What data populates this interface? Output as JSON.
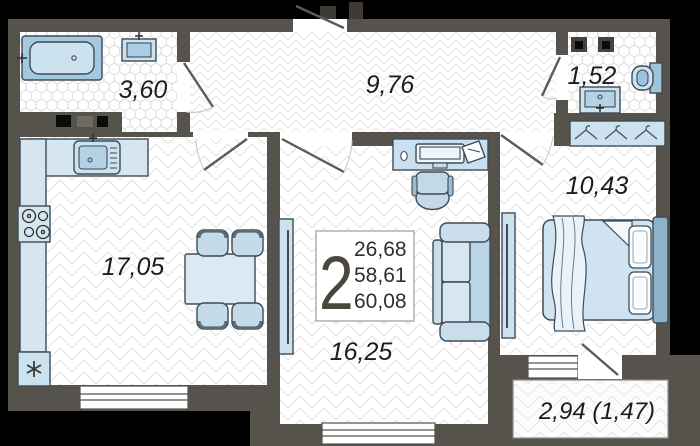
{
  "info_box": {
    "rooms_count": "2",
    "areas": [
      "26,68",
      "58,61",
      "60,08"
    ]
  },
  "rooms": {
    "bathroom": {
      "area": "3,60"
    },
    "hallway": {
      "area": "9,76"
    },
    "wc": {
      "area": "1,52"
    },
    "bedroom": {
      "area": "10,43"
    },
    "kitchen": {
      "area": "17,05"
    },
    "living_room": {
      "area": "16,25"
    },
    "balcony": {
      "area": "2,94 (1,47)"
    }
  },
  "colors": {
    "background": "#000000",
    "wall": "#56524c",
    "floor": "#ffffff",
    "floor_line": "#e1e1e1",
    "furniture_fill": "#cfe2ee",
    "furniture_fill_dark": "#a3c9de",
    "furniture_outline": "#3d4b57",
    "label_text": "#1c1c1c"
  }
}
